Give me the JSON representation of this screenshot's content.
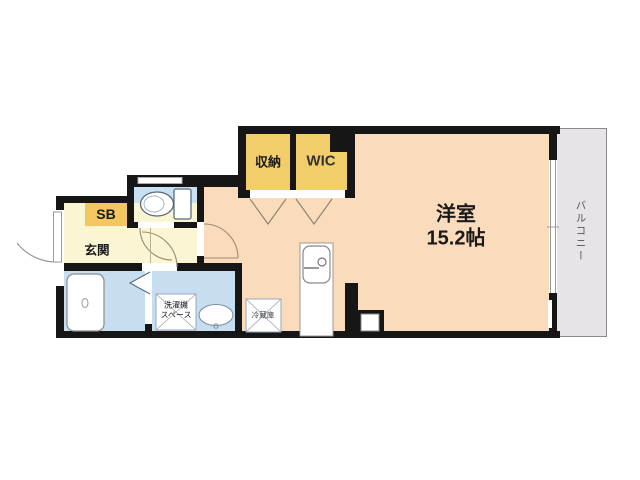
{
  "floorplan": {
    "rooms": {
      "storage": {
        "label": "収納"
      },
      "wic": {
        "label": "WIC"
      },
      "main": {
        "label": "洋室",
        "size": "15.2帖"
      },
      "balcony": {
        "label": "バルコニー"
      },
      "entrance": {
        "label": "玄関"
      },
      "shoebox": {
        "label": "SB"
      },
      "laundry": {
        "line1": "洗濯機",
        "line2": "スペース"
      },
      "fridge": {
        "label": "冷蔵庫"
      }
    },
    "fixtures": [
      "toilet-icon",
      "bathtub-icon",
      "wash-basin-icon",
      "kitchen-sink-icon",
      "entry-door-icon",
      "folding-door-icon"
    ],
    "colors": {
      "wall": "#161616",
      "main_room": "#fadbbc",
      "closet_yellow": "#f2ce6b",
      "shoebox_yellow": "#f3c75f",
      "hall_yellow": "#faf5d2",
      "wet_area_blue": "#c7def1",
      "balcony_gray": "#e6e3e9"
    }
  }
}
